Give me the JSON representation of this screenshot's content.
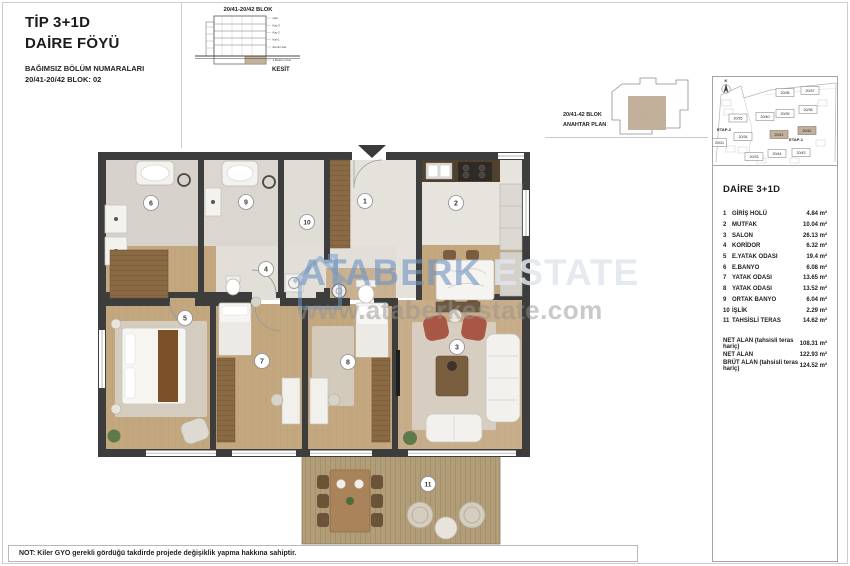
{
  "header": {
    "type_label": "TİP 3+1D",
    "sheet_label": "DAİRE FÖYÜ",
    "numbers_note": "BAĞIMSIZ BÖLÜM NUMARALARI",
    "block_label": "20/41-20/42 BLOK: 02"
  },
  "section_drawing": {
    "title": "20/41-20/42 BLOK",
    "caption": "KESİT",
    "floors": [
      "Çatı",
      "Kat-3",
      "Kat-2",
      "Kat-1",
      "Zemin Kat",
      "1.Bodrum Kat"
    ]
  },
  "key_plan": {
    "line1": "20/41-42 BLOK",
    "line2": "ANAHTAR PLAN"
  },
  "site_plan": {
    "north": "K",
    "etap1": "ETAP-1",
    "etap2": "ETAP-2",
    "blocks": [
      {
        "label": "20/35",
        "highlight": false
      },
      {
        "label": "20/36",
        "highlight": false
      },
      {
        "label": "20/37",
        "highlight": false
      },
      {
        "label": "20/38",
        "highlight": false
      },
      {
        "label": "20/39",
        "highlight": false
      },
      {
        "label": "20/40",
        "highlight": false
      },
      {
        "label": "20/34",
        "highlight": false
      },
      {
        "label": "20/41",
        "highlight": true
      },
      {
        "label": "20/42",
        "highlight": true
      },
      {
        "label": "20/31",
        "highlight": false
      },
      {
        "label": "20/33",
        "highlight": false
      },
      {
        "label": "20/44",
        "highlight": false
      },
      {
        "label": "20/43",
        "highlight": false
      }
    ]
  },
  "floor_plan": {
    "room_numbers": [
      "1",
      "2",
      "3",
      "4",
      "5",
      "6",
      "7",
      "8",
      "9",
      "10",
      "11"
    ],
    "watermark_brand_1": "ATABERK",
    "watermark_brand_2": " ESTATE",
    "watermark_url": "www.ataberkestate.com"
  },
  "unit_panel": {
    "title": "DAİRE 3+1D",
    "rooms": [
      {
        "no": "1",
        "name": "GİRİŞ HOLÜ",
        "area": "4.84 m²"
      },
      {
        "no": "2",
        "name": "MUTFAK",
        "area": "10.04 m²"
      },
      {
        "no": "3",
        "name": "SALON",
        "area": "26.13 m²"
      },
      {
        "no": "4",
        "name": "KORİDOR",
        "area": "6.32 m²"
      },
      {
        "no": "5",
        "name": "E.YATAK ODASI",
        "area": "19.4 m²"
      },
      {
        "no": "6",
        "name": "E.BANYO",
        "area": "6.08 m²"
      },
      {
        "no": "7",
        "name": "YATAK ODASI",
        "area": "13.65 m²"
      },
      {
        "no": "8",
        "name": "YATAK ODASI",
        "area": "13.52 m²"
      },
      {
        "no": "9",
        "name": "ORTAK BANYO",
        "area": "6.04 m²"
      },
      {
        "no": "10",
        "name": "İŞLİK",
        "area": "2.29 m²"
      },
      {
        "no": "11",
        "name": "TAHSİSLİ TERAS",
        "area": "14.62 m²"
      }
    ],
    "totals": [
      {
        "label": "NET ALAN (tahsisli teras hariç)",
        "value": "108.31 m²"
      },
      {
        "label": "NET ALAN",
        "value": "122.93 m²"
      },
      {
        "label": "BRÜT ALAN (tahsisli teras hariç)",
        "value": "124.52 m²"
      }
    ]
  },
  "footer_note": "NOT: Kiler GYO gerekli gördüğü takdirde projede değişiklik yapma hakkına sahiptir.",
  "colors": {
    "wall": "#3d3d3d",
    "wood_floor": "#c3a77f",
    "tile_floor": "#d8d4cd",
    "deck": "#b29d79",
    "accent_armchair": "#a85744",
    "watermark_blue": "#7095c4",
    "highlight_tan": "#c3b19b"
  }
}
